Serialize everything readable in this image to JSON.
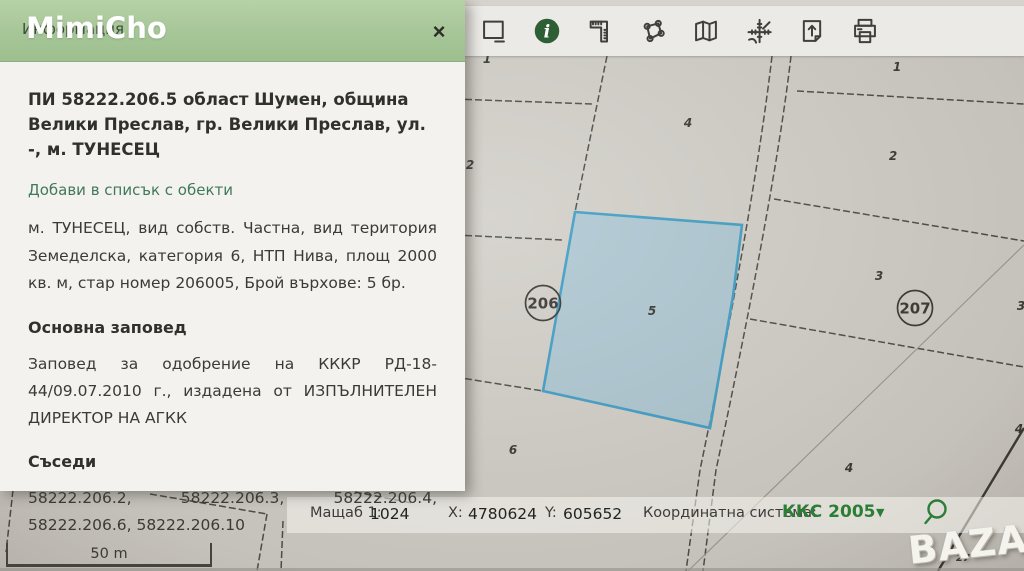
{
  "watermarks": {
    "top_left": "MimiCho",
    "bottom_right": "BAZAR"
  },
  "info_panel": {
    "header_title": "Информация",
    "close_label": "×",
    "object_title": "ПИ 58222.206.5 област Шумен, община Велики Преслав, гр. Велики Преслав, ул. -, м. ТУНЕСЕЦ",
    "add_link": "Добави в списък с обекти",
    "description": "м. ТУНЕСЕЦ, вид собств. Частна, вид територия Земеделска, категория 6, НТП Нива, площ 2000 кв. м, стар номер 206005, Брой върхове: 5 бр.",
    "order_heading": "Основна заповед",
    "order_text": "Заповед за одобрение на КККР РД-18-44/09.07.2010 г., издадена от ИЗПЪЛНИТЕЛЕН ДИРЕКТОР НА АГКК",
    "neighbors_heading": "Съседи",
    "neighbors_text": "58222.206.2, 58222.206.3, 58222.206.4, 58222.206.6, 58222.206.10"
  },
  "toolbar": {
    "icons": [
      "select-extent-icon",
      "info-icon",
      "measure-distance-icon",
      "measure-area-icon",
      "map-icon",
      "coordinate-system-icon",
      "export-icon",
      "print-icon"
    ]
  },
  "map": {
    "selected_parcel": "58222.206.5",
    "labels": [
      {
        "text": "1",
        "x": 487,
        "y": 63
      },
      {
        "text": "4",
        "x": 688,
        "y": 127
      },
      {
        "text": "2",
        "x": 470,
        "y": 169
      },
      {
        "text": "1",
        "x": 897,
        "y": 71
      },
      {
        "text": "2",
        "x": 893,
        "y": 160
      },
      {
        "text": "3",
        "x": 879,
        "y": 280
      },
      {
        "text": "3",
        "x": 1021,
        "y": 310
      },
      {
        "text": "5",
        "x": 652,
        "y": 315
      },
      {
        "text": "6",
        "x": 513,
        "y": 454
      },
      {
        "text": "4",
        "x": 849,
        "y": 472
      },
      {
        "text": "4",
        "x": 1019,
        "y": 433
      },
      {
        "text": "27",
        "x": 963,
        "y": 561
      }
    ],
    "circled_labels": [
      {
        "text": "206",
        "cx": 543,
        "cy": 303
      },
      {
        "text": "207",
        "cx": 915,
        "cy": 308
      }
    ],
    "scale_bar_label": "50 m"
  },
  "status_bar": {
    "scale_label": "Мащаб 1:",
    "scale_value": "1024",
    "x_label": "X:",
    "x_value": "4780624",
    "y_label": "Y:",
    "y_value": "605652",
    "crs_label": "Координатна система:",
    "crs_value": "ККС 2005",
    "crs_caret": "▼"
  },
  "colors": {
    "header_green": "#a6c697",
    "selected_parcel_fill": "#9ac3d8",
    "selected_parcel_border": "#3f9ec6",
    "crs_green": "#2c7d35",
    "info_icon_green": "#2d5e34"
  }
}
